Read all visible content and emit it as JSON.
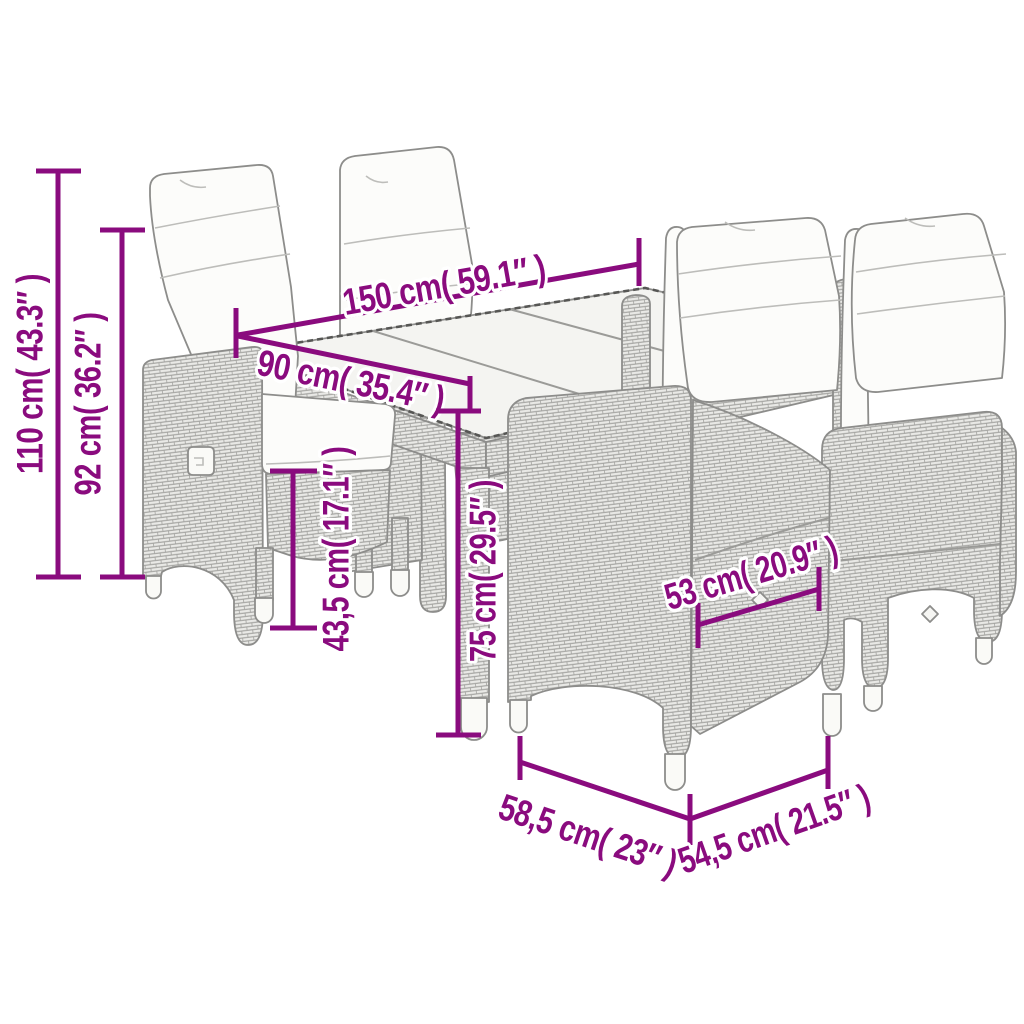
{
  "diagram": {
    "subject": "poly rattan garden dining set: glass-top table with four reclining cushioned chairs",
    "style": "technical product line drawing with dimension annotations",
    "background_color": "#ffffff",
    "annotation_color": "#8a0b7e",
    "furniture_outline_color": "#8d8d8b"
  },
  "dimensions": [
    {
      "id": "chair-total-height",
      "label": "110 cm( 43.3″ )",
      "cm": "110",
      "inches": "43.3"
    },
    {
      "id": "chair-backrest-height",
      "label": "92 cm( 36.2″ )",
      "cm": "92",
      "inches": "36.2"
    },
    {
      "id": "table-length",
      "label": "150 cm( 59.1″ )",
      "cm": "150",
      "inches": "59.1"
    },
    {
      "id": "table-width",
      "label": "90 cm( 35.4″ )",
      "cm": "90",
      "inches": "35.4"
    },
    {
      "id": "seat-height",
      "label": "43,5 cm( 17.1″ )",
      "cm": "43,5",
      "inches": "17.1"
    },
    {
      "id": "table-height",
      "label": "75 cm( 29.5″ )",
      "cm": "75",
      "inches": "29.5"
    },
    {
      "id": "seat-width",
      "label": "53 cm( 20.9″ )",
      "cm": "53",
      "inches": "20.9"
    },
    {
      "id": "chair-depth",
      "label": "58,5 cm( 23″ )",
      "cm": "58,5",
      "inches": "23"
    },
    {
      "id": "chair-width",
      "label": "54,5 cm( 21.5″ )",
      "cm": "54,5",
      "inches": "21.5"
    }
  ]
}
